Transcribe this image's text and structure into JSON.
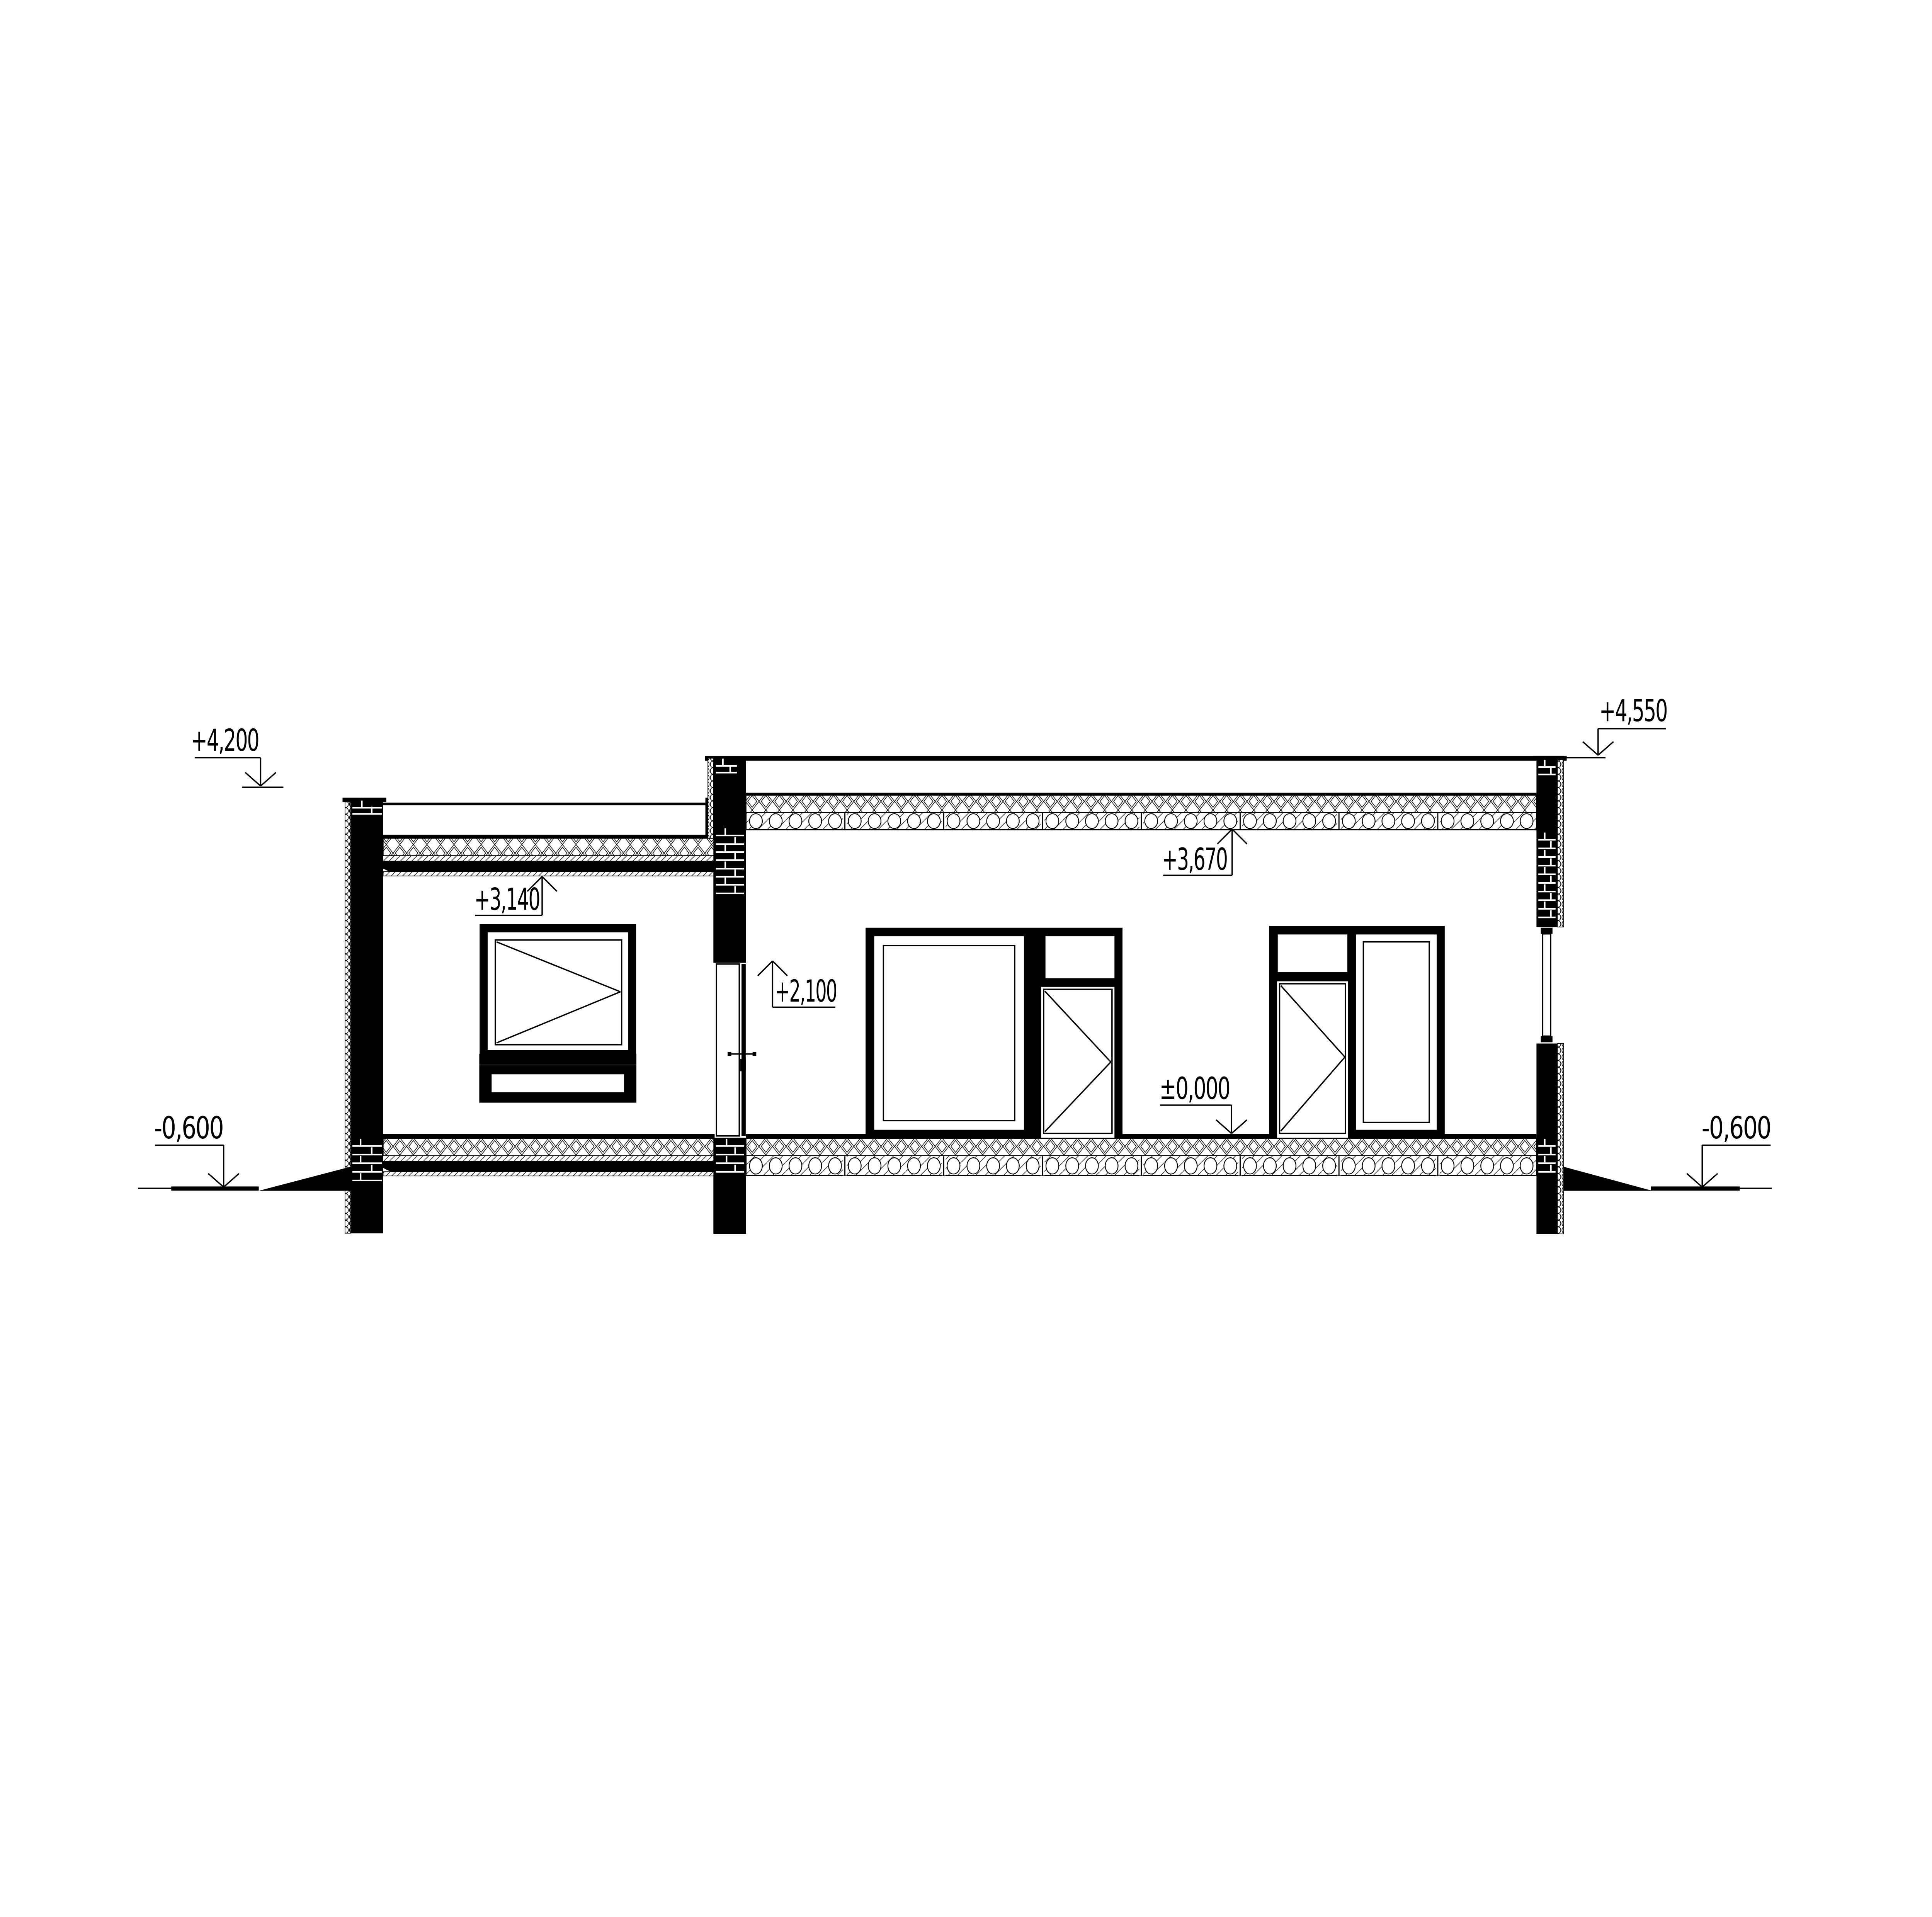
{
  "drawing": {
    "title": "building cross-section drawing",
    "type": "architectural-section",
    "colors": {
      "ink": "#000000",
      "paper": "#ffffff"
    }
  },
  "levels": {
    "left_parapet": {
      "label": "+4,200"
    },
    "right_parapet": {
      "label": "+4,550"
    },
    "left_ceiling": {
      "label": "+3,140"
    },
    "right_ceiling": {
      "label": "+3,670"
    },
    "door_head": {
      "label": "+2,100"
    },
    "floor": {
      "label": "±0,000"
    },
    "ground_left": {
      "label": "-0,600"
    },
    "ground_right": {
      "label": "-0,600"
    }
  }
}
